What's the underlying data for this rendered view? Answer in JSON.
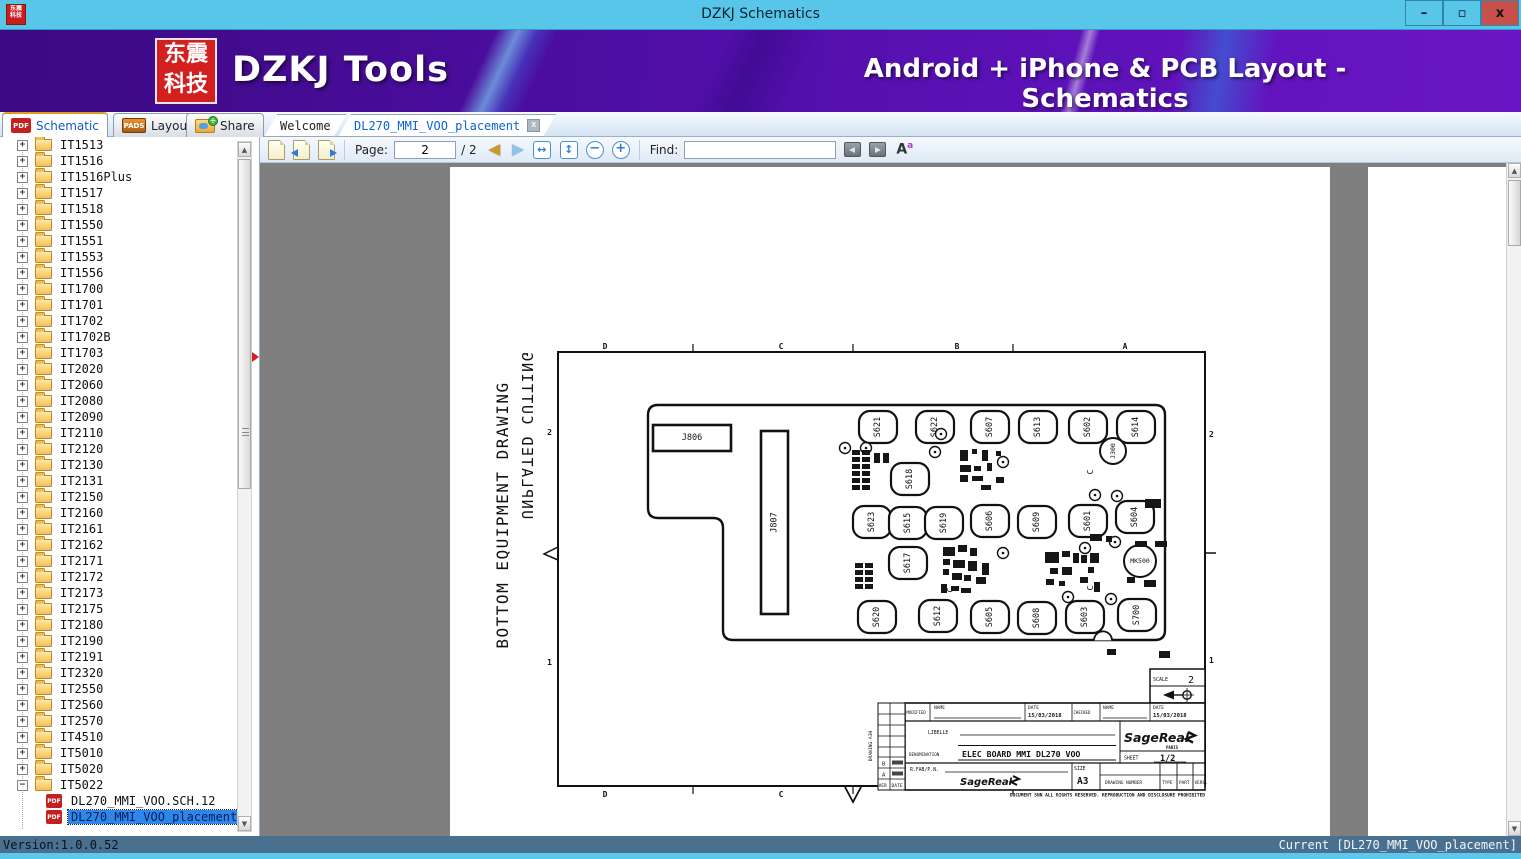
{
  "window": {
    "title": "DZKJ Schematics",
    "minimize": "–",
    "maximize": "▫",
    "close": "x"
  },
  "banner": {
    "logo_line1": "东震",
    "logo_line2": "科技",
    "app_name": "DZKJ Tools",
    "tagline": "Android + iPhone & PCB Layout - Schematics"
  },
  "icons": {
    "pdf": "PDF",
    "pads": "PADS",
    "plus": "+",
    "up": "▲",
    "down": "▼",
    "prev": "◀",
    "next": "▶",
    "fit_width": "↔",
    "fit_page": "↕",
    "zoom_out": "−",
    "zoom_in": "+",
    "font": "A",
    "font_sup": "a",
    "expand": "+",
    "collapse": "−"
  },
  "main_tabs": [
    {
      "label": "Schematic"
    },
    {
      "label": "Layout"
    },
    {
      "label": "Share"
    }
  ],
  "doc_tabs": [
    {
      "label": "Welcome"
    },
    {
      "label": "DL270_MMI_VOO_placement",
      "close": "x"
    }
  ],
  "toolbar": {
    "page_label": "Page:",
    "page_value": "2",
    "page_total": "/ 2",
    "find_label": "Find:",
    "find_value": ""
  },
  "sidebar": {
    "folders": [
      "IT1513",
      "IT1516",
      "IT1516Plus",
      "IT1517",
      "IT1518",
      "IT1550",
      "IT1551",
      "IT1553",
      "IT1556",
      "IT1700",
      "IT1701",
      "IT1702",
      "IT1702B",
      "IT1703",
      "IT2020",
      "IT2060",
      "IT2080",
      "IT2090",
      "IT2110",
      "IT2120",
      "IT2130",
      "IT2131",
      "IT2150",
      "IT2160",
      "IT2161",
      "IT2162",
      "IT2171",
      "IT2172",
      "IT2173",
      "IT2175",
      "IT2180",
      "IT2190",
      "IT2191",
      "IT2320",
      "IT2550",
      "IT2560",
      "IT2570",
      "IT4510",
      "IT5010",
      "IT5020"
    ],
    "expanded_folder": "IT5022",
    "files": [
      {
        "label": "DL270_MMI_VOO.SCH.12",
        "selected": false
      },
      {
        "label": "DL270_MMI_VOO_placement",
        "selected": true
      }
    ]
  },
  "statusbar": {
    "left": "Version:1.0.0.52",
    "right": "Current [DL270_MMI_VOO_placement]"
  },
  "drawing": {
    "side_text_primary": "BOTTOM EQUIPMENT DRAWING",
    "side_text_mirrored": "UNPLATED CUTTING",
    "zones_top": [
      {
        "label": "D",
        "x": 345
      },
      {
        "label": "C",
        "x": 521
      },
      {
        "label": "B",
        "x": 697
      },
      {
        "label": "A",
        "x": 865
      }
    ],
    "zones_bottom": [
      {
        "label": "D",
        "x": 345
      },
      {
        "label": "C",
        "x": 521
      }
    ],
    "zones_left": [
      {
        "label": "2",
        "y": 272
      },
      {
        "label": "1",
        "y": 502
      }
    ],
    "zones_right": [
      {
        "label": "2",
        "y": 274
      },
      {
        "label": "1",
        "y": 500
      }
    ],
    "connectors": [
      {
        "name": "J806",
        "x": 393,
        "y": 262,
        "w": 78,
        "h": 26,
        "rot": false
      },
      {
        "name": "J807",
        "x": 501,
        "y": 268,
        "w": 27,
        "h": 183,
        "rot": true
      }
    ],
    "components": [
      {
        "name": "S621",
        "cx": 618,
        "cy": 264
      },
      {
        "name": "S622",
        "cx": 675,
        "cy": 264
      },
      {
        "name": "S607",
        "cx": 730,
        "cy": 264
      },
      {
        "name": "S613",
        "cx": 778,
        "cy": 264
      },
      {
        "name": "S602",
        "cx": 828,
        "cy": 264
      },
      {
        "name": "S614",
        "cx": 876,
        "cy": 264
      },
      {
        "name": "S618",
        "cx": 650,
        "cy": 316
      },
      {
        "name": "S623",
        "cx": 612,
        "cy": 359
      },
      {
        "name": "S615",
        "cx": 648,
        "cy": 360
      },
      {
        "name": "S619",
        "cx": 684,
        "cy": 360
      },
      {
        "name": "S606",
        "cx": 730,
        "cy": 358
      },
      {
        "name": "S609",
        "cx": 777,
        "cy": 359
      },
      {
        "name": "S601",
        "cx": 828,
        "cy": 358
      },
      {
        "name": "S604",
        "cx": 875,
        "cy": 354
      },
      {
        "name": "S617",
        "cx": 648,
        "cy": 400
      },
      {
        "name": "S620",
        "cx": 617,
        "cy": 454
      },
      {
        "name": "S612",
        "cx": 678,
        "cy": 453
      },
      {
        "name": "S605",
        "cx": 730,
        "cy": 454
      },
      {
        "name": "S608",
        "cx": 777,
        "cy": 455
      },
      {
        "name": "S603",
        "cx": 825,
        "cy": 454
      },
      {
        "name": "S700",
        "cx": 877,
        "cy": 452
      }
    ],
    "round_components": [
      {
        "name": "J300",
        "cx": 853,
        "cy": 288,
        "r": 13,
        "rot": true
      },
      {
        "name": "MK500",
        "cx": 880,
        "cy": 398,
        "r": 16,
        "rot": false
      }
    ],
    "small_circles": [
      [
        585,
        285
      ],
      [
        606,
        285
      ],
      [
        675,
        289
      ],
      [
        743,
        299
      ],
      [
        835,
        332
      ],
      [
        857,
        333
      ],
      [
        743,
        390
      ],
      [
        825,
        385
      ],
      [
        855,
        379
      ],
      [
        808,
        434
      ],
      [
        851,
        436
      ],
      [
        681,
        271
      ]
    ],
    "c_marks": [
      [
        833,
        309
      ],
      [
        693,
        427
      ],
      [
        833,
        425
      ]
    ],
    "small_rects": [
      [
        592,
        287,
        8,
        5
      ],
      [
        602,
        287,
        8,
        5
      ],
      [
        592,
        294,
        8,
        5
      ],
      [
        602,
        294,
        8,
        5
      ],
      [
        592,
        301,
        8,
        5
      ],
      [
        602,
        301,
        8,
        5
      ],
      [
        592,
        308,
        8,
        5
      ],
      [
        602,
        308,
        8,
        5
      ],
      [
        592,
        315,
        8,
        5
      ],
      [
        602,
        315,
        8,
        5
      ],
      [
        592,
        322,
        8,
        5
      ],
      [
        602,
        322,
        8,
        5
      ],
      [
        614,
        290,
        6,
        10
      ],
      [
        623,
        290,
        6,
        10
      ],
      [
        700,
        287,
        8,
        11
      ],
      [
        712,
        286,
        5,
        5
      ],
      [
        722,
        287,
        6,
        11
      ],
      [
        736,
        288,
        5,
        5
      ],
      [
        700,
        302,
        11,
        7
      ],
      [
        714,
        303,
        7,
        5
      ],
      [
        727,
        300,
        5,
        8
      ],
      [
        700,
        312,
        8,
        7
      ],
      [
        712,
        313,
        11,
        5
      ],
      [
        736,
        314,
        8,
        6
      ],
      [
        721,
        322,
        10,
        5
      ],
      [
        595,
        400,
        8,
        5
      ],
      [
        605,
        400,
        8,
        5
      ],
      [
        595,
        407,
        8,
        5
      ],
      [
        605,
        407,
        8,
        5
      ],
      [
        595,
        414,
        8,
        5
      ],
      [
        605,
        414,
        8,
        5
      ],
      [
        595,
        421,
        8,
        5
      ],
      [
        605,
        421,
        8,
        5
      ],
      [
        683,
        384,
        12,
        9
      ],
      [
        698,
        382,
        9,
        7
      ],
      [
        710,
        385,
        7,
        8
      ],
      [
        683,
        396,
        7,
        6
      ],
      [
        693,
        397,
        12,
        8
      ],
      [
        708,
        398,
        9,
        10
      ],
      [
        722,
        400,
        7,
        12
      ],
      [
        683,
        406,
        6,
        6
      ],
      [
        692,
        410,
        10,
        7
      ],
      [
        704,
        412,
        7,
        6
      ],
      [
        716,
        414,
        10,
        7
      ],
      [
        681,
        421,
        6,
        9
      ],
      [
        691,
        423,
        8,
        5
      ],
      [
        701,
        425,
        10,
        5
      ],
      [
        785,
        389,
        14,
        11
      ],
      [
        802,
        388,
        8,
        6
      ],
      [
        813,
        390,
        6,
        10
      ],
      [
        790,
        405,
        8,
        6
      ],
      [
        802,
        404,
        10,
        8
      ],
      [
        786,
        416,
        8,
        6
      ],
      [
        799,
        418,
        6,
        5
      ],
      [
        821,
        392,
        6,
        8
      ],
      [
        830,
        390,
        9,
        10
      ],
      [
        828,
        404,
        6,
        6
      ],
      [
        820,
        414,
        8,
        6
      ],
      [
        834,
        419,
        6,
        10
      ],
      [
        830,
        371,
        12,
        7
      ],
      [
        846,
        373,
        6,
        6
      ],
      [
        875,
        378,
        12,
        6
      ],
      [
        895,
        378,
        12,
        6
      ],
      [
        867,
        414,
        8,
        6
      ],
      [
        884,
        417,
        12,
        7
      ],
      [
        847,
        486,
        9,
        6
      ],
      [
        899,
        488,
        11,
        7
      ],
      [
        885,
        336,
        16,
        9
      ]
    ],
    "title_block": {
      "scale_label": "SCALE",
      "scale_value": "2",
      "modified": "MODIFIED",
      "name_label": "NAME",
      "date_label": "DATE",
      "date1": "15/03/2018",
      "checked": "CHECKED",
      "date2": "15/03/2018",
      "libelle": "LIBELLE",
      "denomination_label": "DENOMINATION",
      "denomination": "ELEC BOARD MMI DL270 VOO",
      "brand": "SageReal",
      "brand_sub": "PARIS",
      "sheet_label": "SHEET",
      "sheet_value": "1/2",
      "rfab": "R.FAB/P.N.",
      "size_label": "SIZE",
      "size_value": "A3",
      "drawing_number": "DRAWING NUMBER",
      "type_label": "TYPE",
      "part_label": "PART",
      "vers_label": "VERS.",
      "rev_b": "B",
      "rev_a": "A",
      "ver_label": "VER",
      "date_col_label": "DATE",
      "side_note": "DRAWING A3H",
      "footer": "DOCUMENT SNN ALL RIGHTS RESERVED. REPRODUCTION AND DISCLOSURE PROHIBITED"
    }
  }
}
